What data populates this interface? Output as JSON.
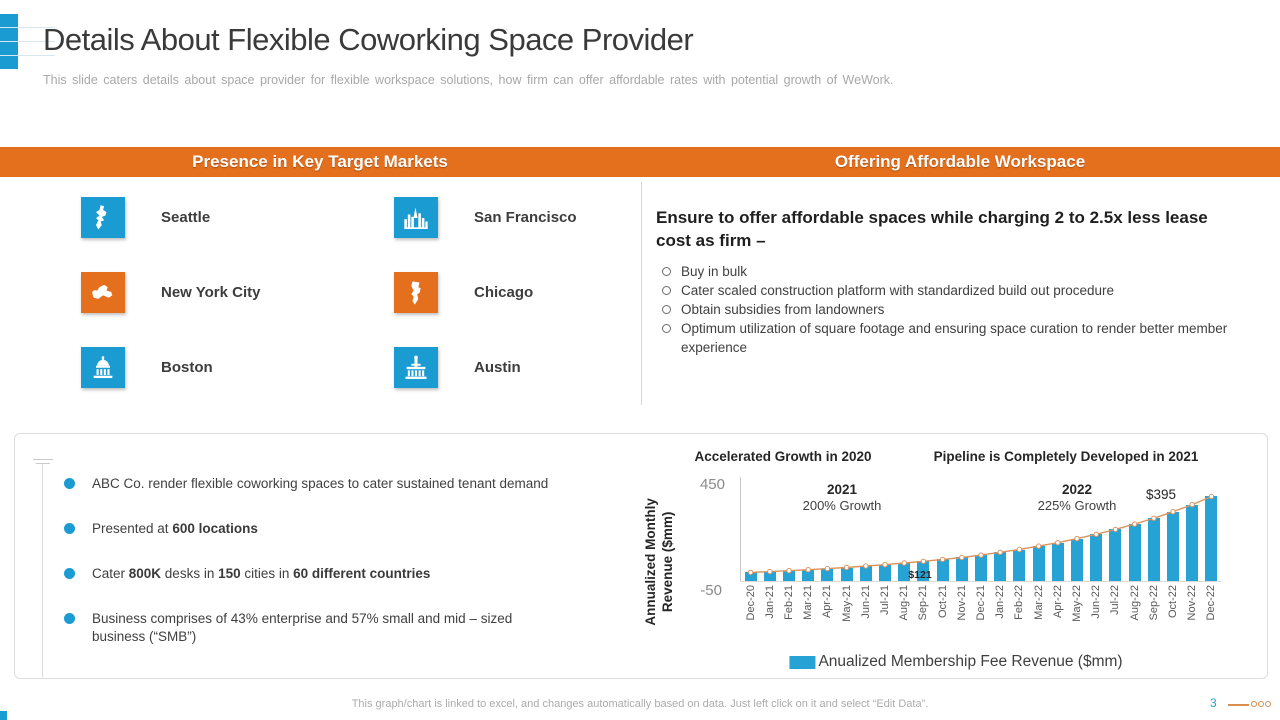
{
  "slide": {
    "title": "Details About Flexible Coworking Space Provider",
    "subtitle": "This slide caters details about space provider for flexible workspace solutions, how firm can offer affordable rates with potential growth of WeWork.",
    "page_number": "3",
    "footer_note": "This graph/chart is linked to excel, and changes automatically based on data. Just left click on it and select “Edit Data”."
  },
  "headers": {
    "left": "Presence in Key Target Markets",
    "right": "Offering Affordable Workspace"
  },
  "markets": {
    "cities": [
      {
        "name": "Seattle",
        "color": "#1A9CD2",
        "icon": "seattle-map-icon"
      },
      {
        "name": "San Francisco",
        "color": "#1A9CD2",
        "icon": "san-francisco-skyline-icon"
      },
      {
        "name": "New York City",
        "color": "#E4701E",
        "icon": "new-york-map-icon"
      },
      {
        "name": "Chicago",
        "color": "#E4701E",
        "icon": "chicago-map-icon"
      },
      {
        "name": "Boston",
        "color": "#1A9CD2",
        "icon": "boston-building-icon"
      },
      {
        "name": "Austin",
        "color": "#1A9CD2",
        "icon": "austin-capitol-icon"
      }
    ]
  },
  "workspace": {
    "heading": "Ensure to offer affordable spaces while charging 2 to 2.5x less lease cost as firm –",
    "bullets": [
      "Buy in bulk",
      "Cater scaled construction platform with standardized build out procedure",
      "Obtain subsidies from landowners",
      "Optimum utilization of square footage and ensuring space curation to render better member experience"
    ]
  },
  "highlights": {
    "items": [
      {
        "parts": [
          {
            "text": "ABC Co. render flexible coworking spaces to cater sustained tenant demand",
            "bold": false
          }
        ]
      },
      {
        "parts": [
          {
            "text": "Presented at ",
            "bold": false
          },
          {
            "text": "600 locations",
            "bold": true
          }
        ]
      },
      {
        "parts": [
          {
            "text": "Cater ",
            "bold": false
          },
          {
            "text": "800K",
            "bold": true
          },
          {
            "text": " desks in ",
            "bold": false
          },
          {
            "text": "150",
            "bold": true
          },
          {
            "text": " cities in ",
            "bold": false
          },
          {
            "text": "60 different countries",
            "bold": true
          }
        ]
      },
      {
        "parts": [
          {
            "text": "Business comprises of 43% enterprise and 57% small and mid – sized business (“SMB”)",
            "bold": false
          }
        ]
      }
    ]
  },
  "chart_data": {
    "type": "bar",
    "titles": {
      "left": "Accelerated Growth in 2020",
      "right": "Pipeline is Completely Developed in 2021"
    },
    "ylabel": "Annualized Monthly Revenue ($mm)",
    "yticks": {
      "top": "450",
      "bottom": "-50"
    },
    "ylim": [
      -50,
      450
    ],
    "categories": [
      "Dec-20",
      "Jan-21",
      "Feb-21",
      "Mar-21",
      "Apr-21",
      "May-21",
      "Jun-21",
      "Jul-21",
      "Aug-21",
      "Sep-21",
      "Oct-21",
      "Nov-21",
      "Dec-21",
      "Jan-22",
      "Feb-22",
      "Mar-22",
      "Apr-22",
      "May-22",
      "Jun-22",
      "Jul-22",
      "Aug-22",
      "Sep-22",
      "Oct-22",
      "Nov-22",
      "Dec-22"
    ],
    "series": [
      {
        "name": "Anualized Membership Fee Revenue ($mm)",
        "type": "bar",
        "color": "#27A2D4",
        "values": [
          40,
          44,
          48,
          53,
          58,
          63,
          70,
          76,
          84,
          92,
          101,
          110,
          121,
          134,
          147,
          163,
          179,
          198,
          218,
          241,
          266,
          293,
          324,
          357,
          395
        ]
      },
      {
        "name": "trend",
        "type": "line",
        "color": "#DB9460",
        "values": [
          40,
          44,
          48,
          53,
          58,
          63,
          70,
          76,
          84,
          92,
          101,
          110,
          121,
          134,
          147,
          163,
          179,
          198,
          218,
          241,
          266,
          293,
          324,
          357,
          395
        ]
      }
    ],
    "annotations": {
      "y2021": {
        "label": "2021",
        "sub": "200% Growth"
      },
      "y2022": {
        "label": "2022",
        "sub": "225% Growth"
      },
      "peak": "$395",
      "mid": "$121"
    },
    "legend": "Anualized Membership Fee Revenue ($mm)",
    "grid": false,
    "legend_position": "bottom"
  }
}
